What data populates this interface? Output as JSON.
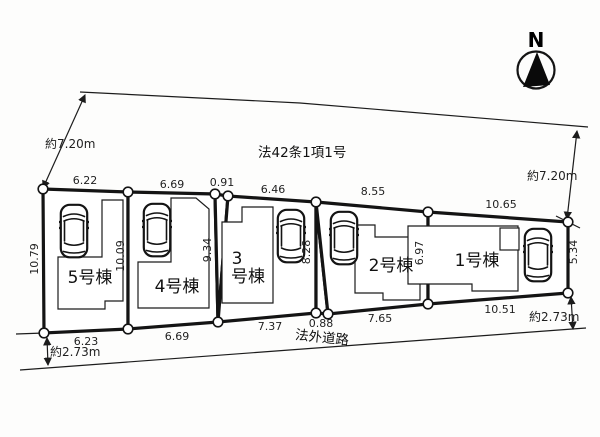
{
  "meta": {
    "background": "#fdfdfc",
    "line_color": "#1c1c1c",
    "drawing_type": "分譲地 区画図 (residential site plan)"
  },
  "compass": {
    "label": "N"
  },
  "legal_note": "法42条1項1号",
  "road": {
    "label": "法外道路",
    "width_left": "約2.73m",
    "width_right": "約2.73m"
  },
  "depth": {
    "left": "約7.20m",
    "right": "約7.20m"
  },
  "lots": [
    {
      "label": "5号棟"
    },
    {
      "label": "4号棟"
    },
    {
      "label": "3号棟",
      "label_lines": [
        "3",
        "号棟"
      ]
    },
    {
      "label": "2号棟"
    },
    {
      "label": "1号棟"
    }
  ],
  "dims": {
    "top": [
      "6.22",
      "6.69",
      "0.91",
      "6.46",
      "8.55",
      "10.65"
    ],
    "bottom": [
      "6.23",
      "6.69",
      "7.37",
      "0.88",
      "7.65",
      "10.51"
    ],
    "vertical": [
      "10.79",
      "10.09",
      "9.34",
      "8.28",
      "6.97",
      "5.34"
    ]
  }
}
